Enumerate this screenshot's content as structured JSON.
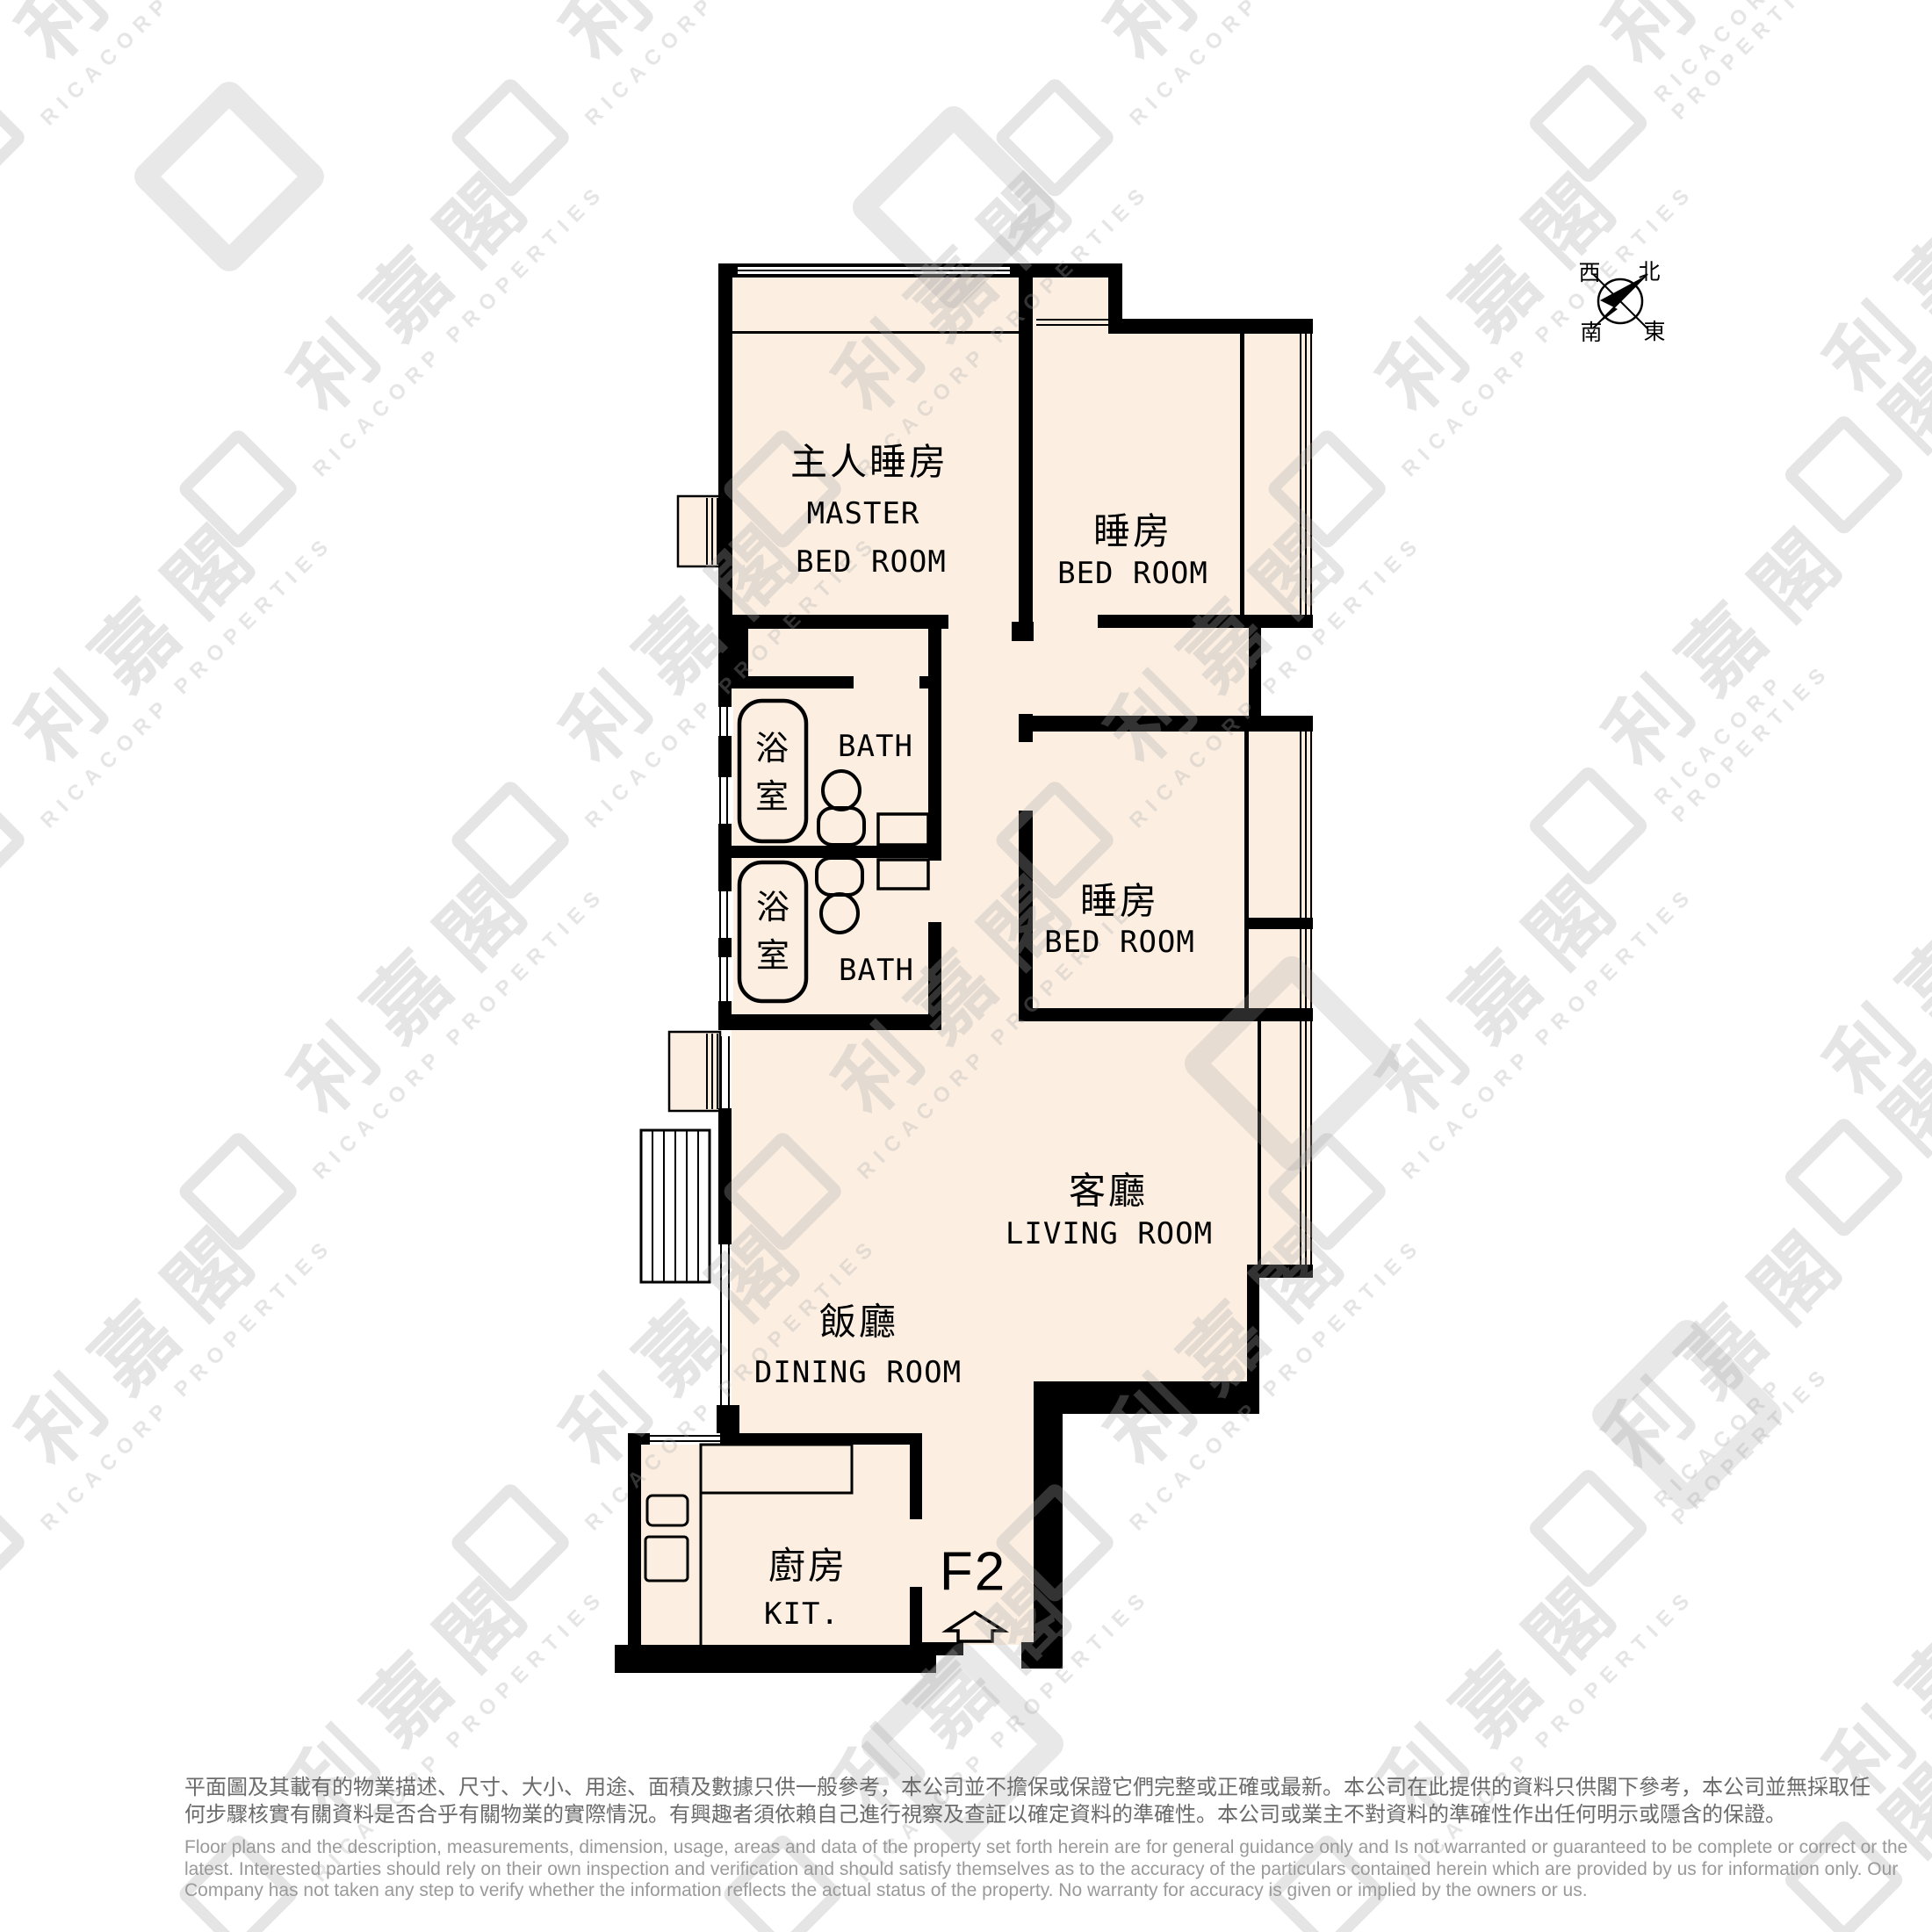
{
  "plan": {
    "unit_label": "F2",
    "rooms": {
      "master_bedroom": {
        "zh": "主人睡房",
        "en_line1": "MASTER",
        "en_line2": "BED ROOM"
      },
      "bedroom1": {
        "zh": "睡房",
        "en": "BED ROOM"
      },
      "bedroom2": {
        "zh": "睡房",
        "en": "BED ROOM"
      },
      "bath1": {
        "zh": "浴\n室",
        "en": "BATH"
      },
      "bath2": {
        "zh": "浴\n室",
        "en": "BATH"
      },
      "living_room": {
        "zh": "客廳",
        "en": "LIVING ROOM"
      },
      "dining_room": {
        "zh": "飯廳",
        "en": "DINING ROOM"
      },
      "kitchen": {
        "zh": "廚房",
        "en": "KIT."
      }
    },
    "compass": {
      "north": "北",
      "south": "南",
      "east": "東",
      "west": "西"
    }
  },
  "watermark": {
    "cjk": "利嘉閣",
    "latin": "RICACORP PROPERTIES"
  },
  "disclaimer": {
    "zh_line1": "平面圖及其載有的物業描述、尺寸、大小、用途、面積及數據只供一般參考，本公司並不擔保或保證它們完整或正確或最新。本公司在此提供的資料只供閣下參考，本公司並無採取任",
    "zh_line2": "何步驟核實有關資料是否合乎有關物業的實際情況。有興趣者須依賴自己進行視察及查証以確定資料的準確性。本公司或業主不對資料的準確性作出任何明示或隱含的保證。",
    "en_line1": "Floor plans and the description, measurements, dimension, usage, areas and data of the property set forth herein are for general guidance only and Is not warranted or guaranteed to be complete or correct or the",
    "en_line2": "latest. Interested parties should rely on their own inspection and verification and should satisfy themselves as to the accuracy of the particulars contained herein which are provided by us for information only.  Our",
    "en_line3": "Company has not taken any step to verify whether the information reflects the actual status of the property.  No warranty for accuracy is given or implied by the owners or us."
  },
  "colors": {
    "room_fill": "#fcefe2",
    "wall": "#000000",
    "disclaimer_zh": "#6b6b6b",
    "disclaimer_en": "#9a9a9a",
    "watermark": "#e8e8e8"
  }
}
